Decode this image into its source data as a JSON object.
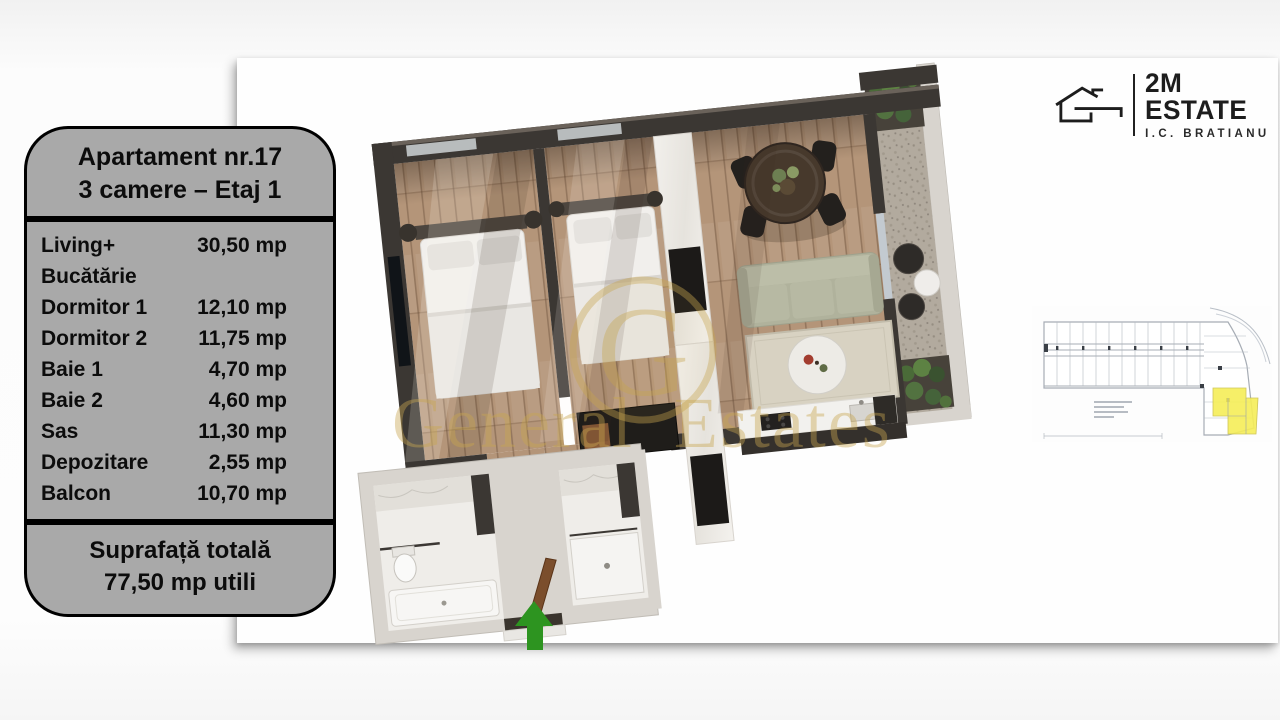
{
  "panel": {
    "title_line1": "Apartament nr.17",
    "title_line2": "3 camere – Etaj 1",
    "rows": [
      {
        "label": "Living+",
        "area": "30,50 mp"
      },
      {
        "label": "Bucătărie",
        "area": ""
      },
      {
        "label": "Dormitor 1",
        "area": "12,10 mp"
      },
      {
        "label": "Dormitor 2",
        "area": "11,75 mp"
      },
      {
        "label": "Baie 1",
        "area": "4,70 mp"
      },
      {
        "label": "Baie 2",
        "area": "4,60 mp"
      },
      {
        "label": "Sas",
        "area": "11,30 mp"
      },
      {
        "label": "Depozitare",
        "area": "2,55 mp"
      },
      {
        "label": "Balcon",
        "area": "10,70 mp"
      }
    ],
    "total_label": "Suprafață totală",
    "total_value": "77,50 mp utili"
  },
  "logo": {
    "brand": "2M ESTATE",
    "subtitle": "I.C. BRATIANU"
  },
  "watermark": {
    "text": "General Estates",
    "monogram": "G"
  },
  "colors": {
    "panel_bg": "#a9a9a9",
    "panel_border": "#000000",
    "highlight_yellow": "#f6ee58",
    "arrow_green": "#2d9420",
    "watermark_gold": "#c8a650",
    "logo_black": "#1d1d1d"
  }
}
